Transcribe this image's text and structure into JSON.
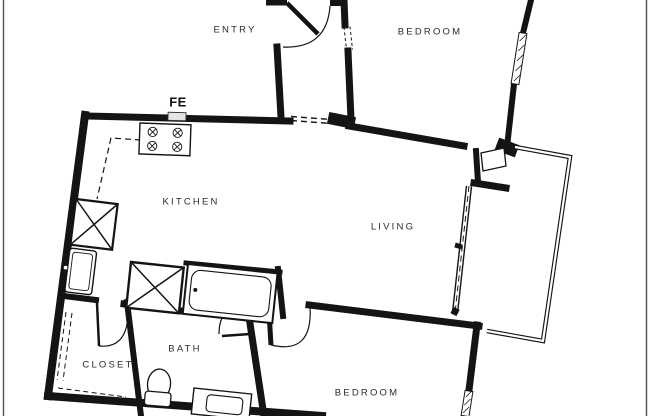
{
  "floor_plan": {
    "labels": {
      "entry": "ENTRY",
      "bedroom_top": "BEDROOM",
      "fire_extinguisher": "FE",
      "kitchen": "KITCHEN",
      "living": "LIVING",
      "bath": "BATH",
      "closet": "CLOSET",
      "bedroom_bottom": "BEDROOM"
    },
    "colors": {
      "wall": "#141414",
      "background": "#ffffff",
      "label_text": "#2b2b2b",
      "frame_border": "#4f4f4f",
      "fe_cabinet_fill": "#e3e3e3"
    }
  }
}
